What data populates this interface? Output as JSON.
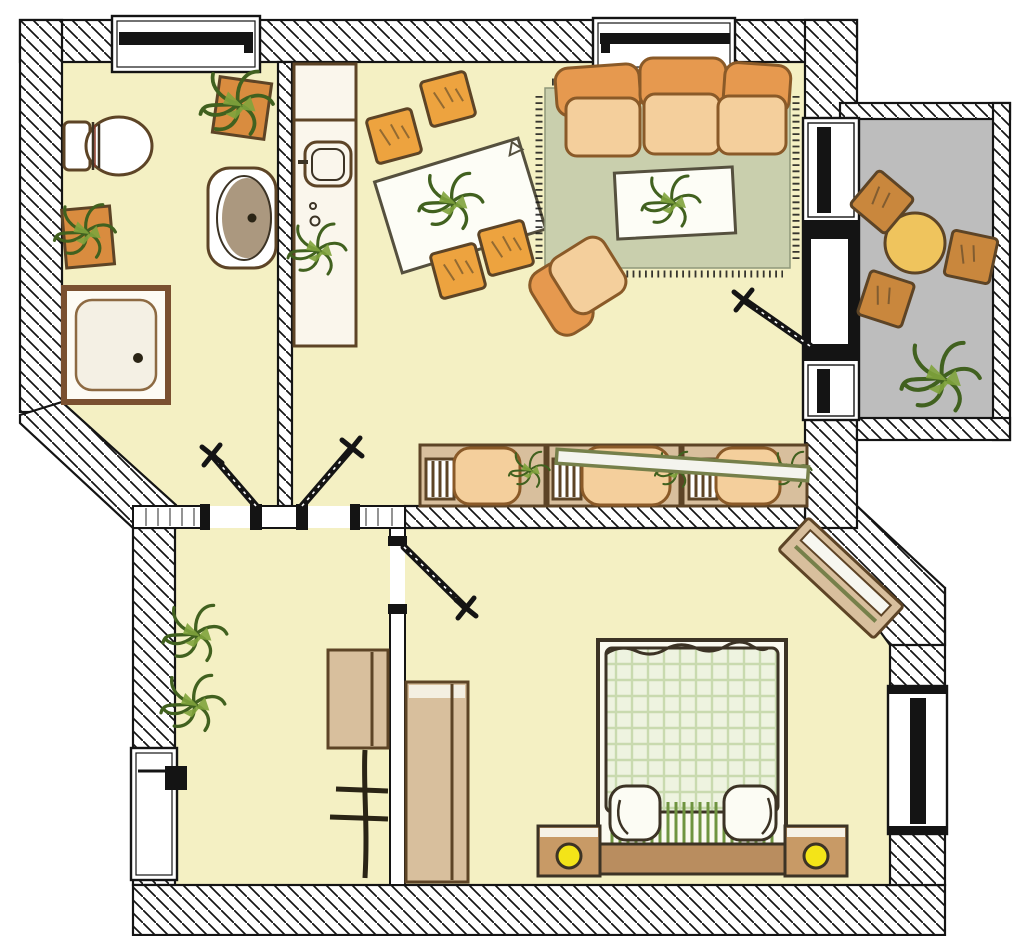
{
  "meta": {
    "type": "apartment-floor-plan",
    "style": "hand-drawn colored architectural plan, top view, no text labels",
    "canvas": {
      "width": 1024,
      "height": 936
    }
  },
  "colors": {
    "paper": "#ffffff",
    "ink": "#141414",
    "floor": "#f4f0c3",
    "balcony_floor": "#bdbdbd",
    "rug": "#c9cfad",
    "rug_edge": "#8f987a",
    "upholstery": "#e6994f",
    "upholstery_light": "#f4cf9c",
    "upholstery_dark": "#8a5a28",
    "wood": "#d8bf9d",
    "wood_mid": "#b98d5f",
    "wood_dark": "#5d4426",
    "counter": "#faf6ec",
    "table_white": "#fdfdf6",
    "table_yellow": "#efc45d",
    "chair_orange": "#eda33f",
    "chair_brown": "#c9873d",
    "plant_dark": "#41611f",
    "plant_mid": "#7fa33c",
    "plant_light": "#b9cc79",
    "pot": "#d98c3f",
    "blanket": "#eef3e0",
    "blanket_grid": "#b9d09a",
    "fringe_green": "#6f9440",
    "lamp": "#f3e418",
    "basin": "#9c8668",
    "gray_ink": "#3c3325",
    "plank_edge": "#76804a"
  },
  "rooms": [
    {
      "id": "bathroom",
      "position": "top-left",
      "furniture": [
        "toilet",
        "washbasin",
        "shower",
        "potted-plant",
        "potted-plant"
      ],
      "windows": 1,
      "doors": 1
    },
    {
      "id": "kitchen-dining",
      "position": "top-middle",
      "furniture": [
        "kitchen-counter-with-sink",
        "counter-plant",
        "dining-table-with-plant",
        "chair",
        "chair",
        "chair",
        "chair"
      ],
      "windows": 0,
      "doors": 1
    },
    {
      "id": "living-room",
      "position": "top-right",
      "furniture": [
        "three-seat-sofa",
        "area-rug",
        "coffee-table-with-plant",
        "armchair",
        "sideboard-row-with-cushions-and-plants",
        "diagonal-plank-shelf"
      ],
      "windows": 1,
      "balcony_door": 1
    },
    {
      "id": "balcony",
      "position": "right",
      "floor": "gray",
      "furniture": [
        "round-table",
        "chair",
        "chair",
        "chair",
        "potted-plant"
      ]
    },
    {
      "id": "hall",
      "position": "bottom-left",
      "furniture": [
        "entrance-door",
        "wall-cabinet",
        "coat-rack",
        "potted-plant",
        "potted-plant"
      ]
    },
    {
      "id": "bedroom",
      "position": "bottom-right",
      "furniture": [
        "double-bed-with-checked-blanket",
        "nightstand-with-lamp",
        "nightstand-with-lamp",
        "wardrobe",
        "diagonal-shelf"
      ],
      "windows": 1,
      "doors": 1
    }
  ],
  "openings": {
    "exterior_windows": [
      "bathroom-top",
      "living-room-top",
      "balcony-upper",
      "balcony-lower",
      "bedroom-right"
    ],
    "doors": [
      "entrance-hall-left",
      "bathroom",
      "kitchen",
      "bedroom",
      "balcony"
    ]
  }
}
